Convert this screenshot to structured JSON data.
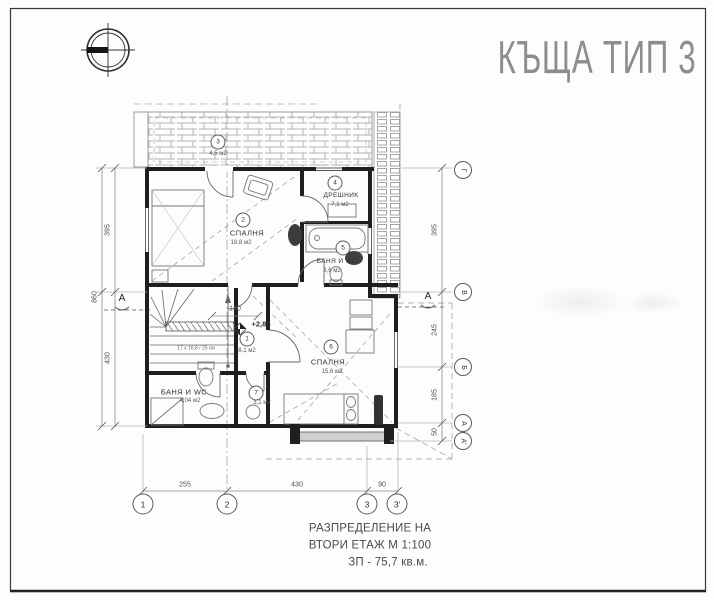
{
  "title": "КЪЩА ТИП 3",
  "caption": {
    "line1": "РАЗПРЕДЕЛЕНИЕ НА",
    "line2": "ВТОРИ ЕТАЖ М 1:100",
    "line3": "ЗП - 75,7 кв.м."
  },
  "rooms": {
    "hall": {
      "num": "1",
      "area": "8,1 м2"
    },
    "bedroom2": {
      "num": "2",
      "name": "СПАЛНЯ",
      "area": "18,8 м2"
    },
    "terrace": {
      "num": "3",
      "area": "4,5 м2"
    },
    "closet": {
      "num": "4",
      "name": "ДРЕШНИК",
      "area": "7,1 м2"
    },
    "bath": {
      "num": "5",
      "name": "БАНЯ И WC",
      "area": "3,6 м2"
    },
    "bedroom6": {
      "num": "6",
      "name": "СПАЛНЯ",
      "area": "15,6 м2"
    },
    "room7": {
      "num": "7",
      "area": "3,1 м2"
    },
    "bath_wc": {
      "name": "БАНЯ И WC",
      "area": "4,04 м2"
    }
  },
  "annotations": {
    "level": "+2,85",
    "stair_width": "140",
    "stair_note": "17 х 16,8 / 25 см",
    "section": "А"
  },
  "dims": {
    "bottom": [
      "255",
      "430",
      "90"
    ],
    "left_inner": [
      "395",
      "430"
    ],
    "left_outer": "860",
    "right": [
      "395",
      "245",
      "185",
      "50"
    ]
  },
  "grid": {
    "bottom": [
      "1",
      "2",
      "3",
      "3'"
    ],
    "right": [
      "Г",
      "В",
      "Б",
      "А",
      "А'"
    ]
  },
  "colors": {
    "wall": "#1e1e1e",
    "thin_line": "#6f6f6f",
    "dimension": "#8a8a8a",
    "title_grey": "#8d8d8d",
    "hatch": "#b3b3b3"
  }
}
